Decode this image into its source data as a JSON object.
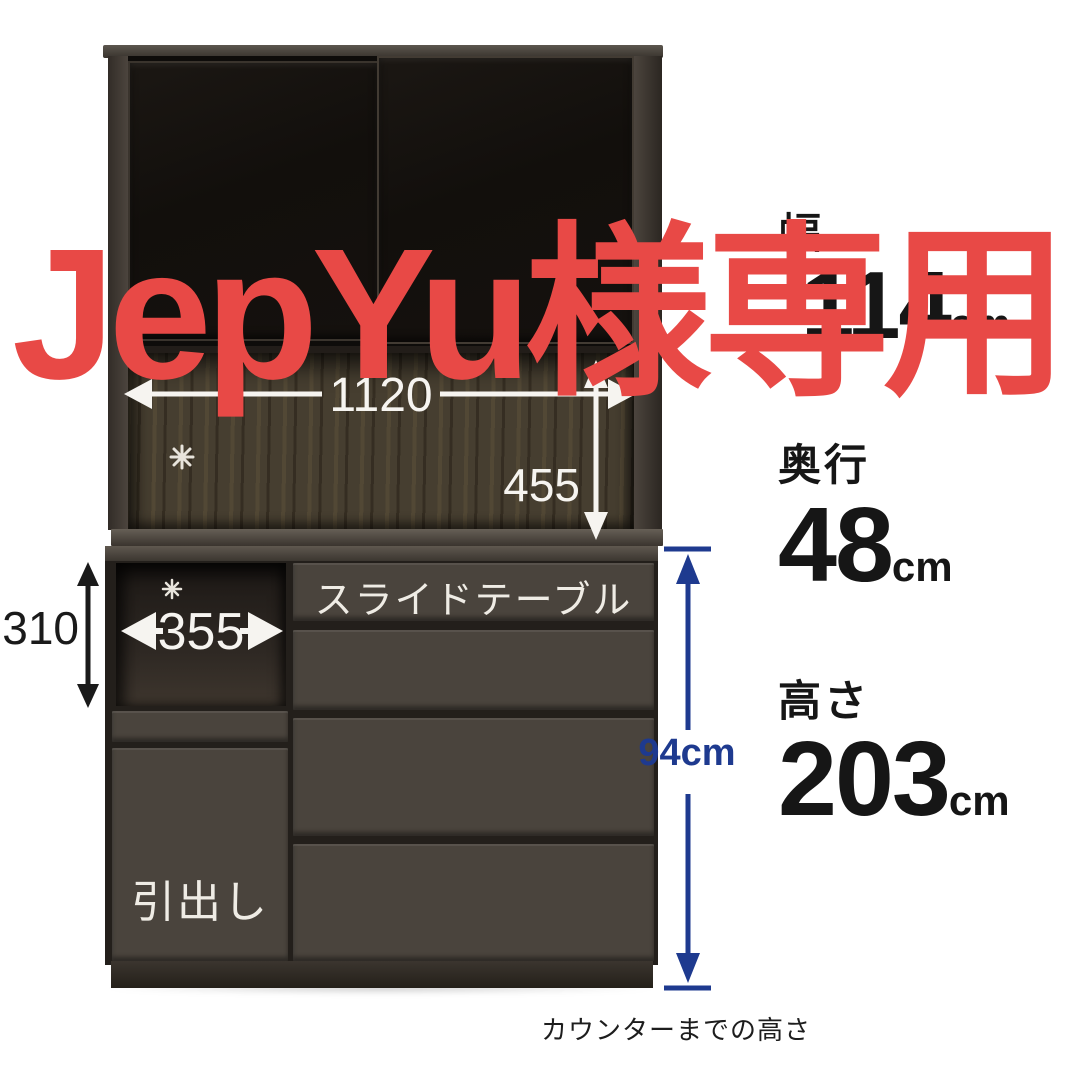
{
  "overlay": {
    "reserved_text": "JepYu様専用"
  },
  "spec_panel": {
    "width": {
      "label": "幅",
      "value": "114",
      "unit": "cm"
    },
    "depth": {
      "label": "奥行",
      "value": "48",
      "unit": "cm"
    },
    "height": {
      "label": "高さ",
      "value": "203",
      "unit": "cm"
    }
  },
  "diagram": {
    "inner_width_mm": "1120",
    "upper_clearance_mm": "455",
    "niche_height_mm": "310",
    "niche_width_mm": "355",
    "counter_height": "94cm",
    "counter_height_caption": "カウンターまでの高さ",
    "slide_table_label": "スライドテーブル",
    "drawer_label": "引出し"
  },
  "colors": {
    "overlay_red": "#e84946",
    "arrow_white": "#f6f4f0",
    "arrow_black": "#1a1a1a",
    "arrow_navy": "#1e3a8f"
  }
}
